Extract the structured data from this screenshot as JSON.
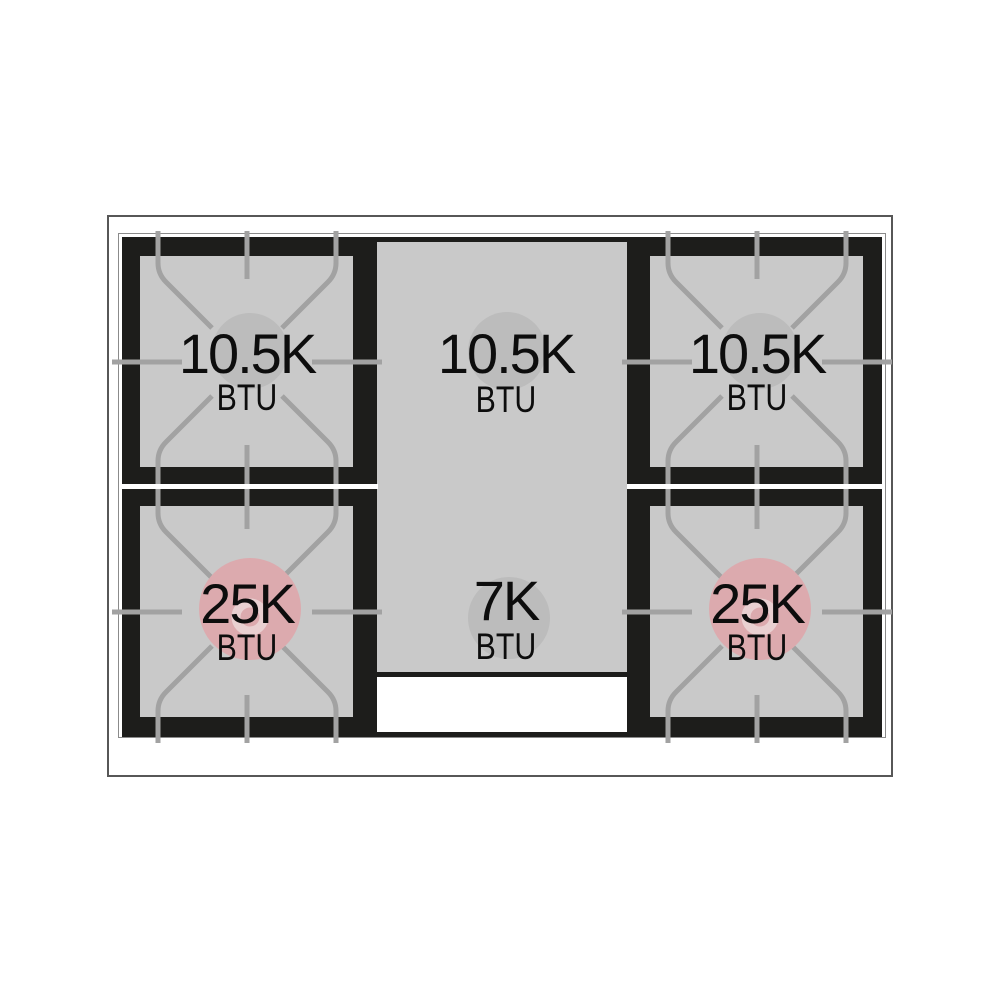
{
  "diagram": {
    "title": "Gas range cooktop burner layout",
    "unit": "BTU",
    "burners": [
      {
        "position": "top-left",
        "rating": "10.5K",
        "unit": "BTU",
        "style": "standard"
      },
      {
        "position": "top-center",
        "rating": "10.5K",
        "unit": "BTU",
        "style": "center-zone"
      },
      {
        "position": "top-right",
        "rating": "10.5K",
        "unit": "BTU",
        "style": "standard"
      },
      {
        "position": "bottom-left",
        "rating": "25K",
        "unit": "BTU",
        "style": "high-power"
      },
      {
        "position": "bottom-center",
        "rating": "7K",
        "unit": "BTU",
        "style": "center-zone"
      },
      {
        "position": "bottom-right",
        "rating": "25K",
        "unit": "BTU",
        "style": "high-power"
      }
    ],
    "colors": {
      "plate_black": "#1d1d1b",
      "surface_gray": "#c9c9c9",
      "grate_gray": "#a2a2a2",
      "burner_cap_gray": "#bcbcbc",
      "high_power_pink": "#dcaaae",
      "high_power_ring": "#e9d0d1",
      "frame_line": "#575757",
      "hairline": "#8b8b8b",
      "text": "#0d0d0d"
    }
  }
}
